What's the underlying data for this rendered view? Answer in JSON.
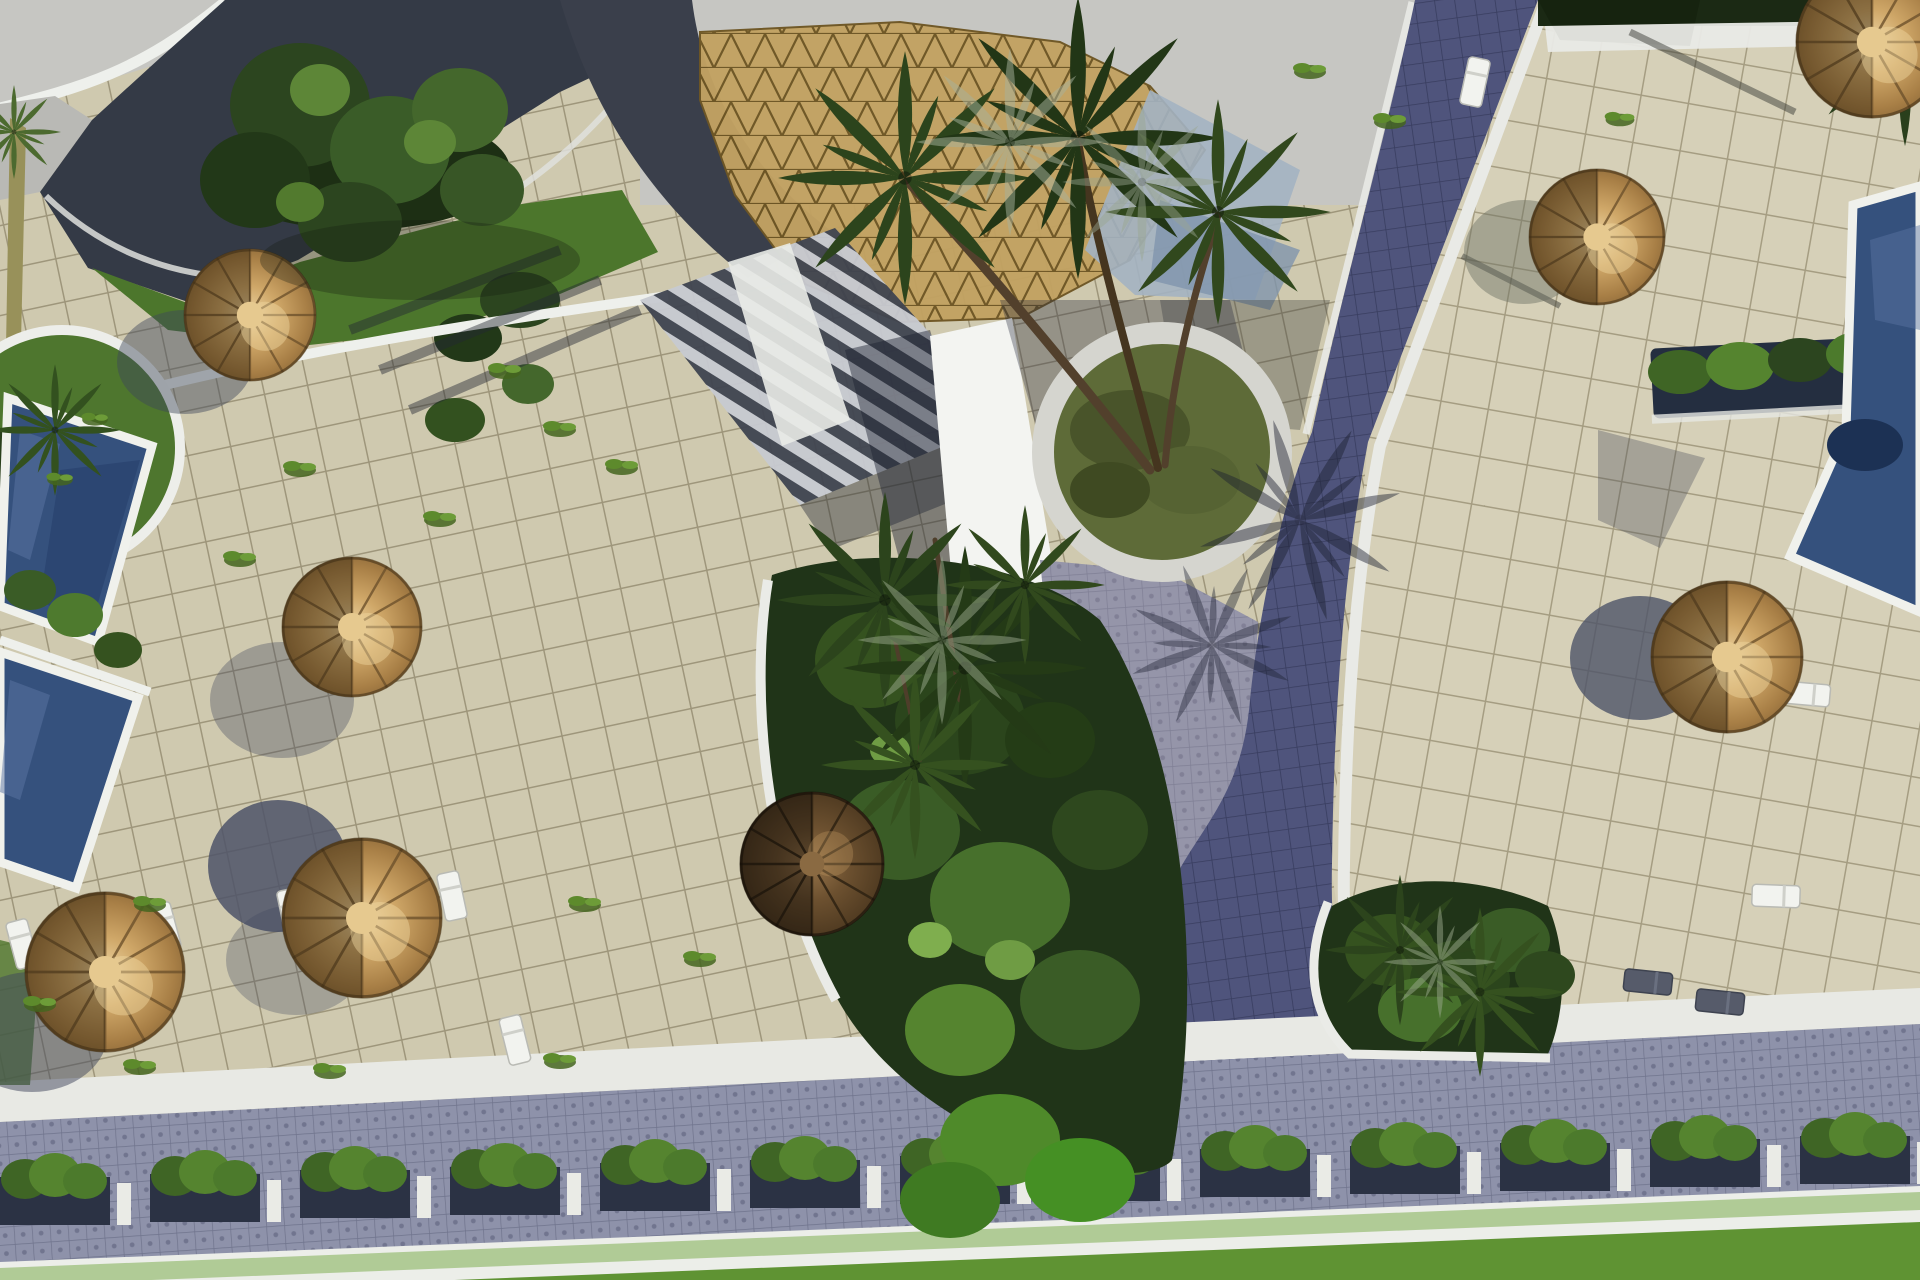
{
  "scene": {
    "description": "Aerial 3D architectural rendering of a resort pool courtyard: beige paved terraces, dark-blue swimming pools with white rims, indigo paver walkways, straw parasols with sun loungers, palm trees in round and organic planters, a golden lattice dome roof at top, a bottom road lined with shrub planter boxes and a green lawn strip.",
    "setting": "resort-courtyard-aerial-render",
    "visible_text": [],
    "counts": {
      "straw_umbrellas": 7,
      "dark_umbrellas": 1,
      "swimming_pools": 3,
      "lounge_chairs": 10,
      "planter_boxes": 13,
      "palm_clusters": 6
    },
    "umbrellas": [
      {
        "x": 250,
        "y": 315,
        "r": 66
      },
      {
        "x": 352,
        "y": 627,
        "r": 70
      },
      {
        "x": 105,
        "y": 972,
        "r": 80
      },
      {
        "x": 362,
        "y": 918,
        "r": 80
      },
      {
        "x": 1597,
        "y": 237,
        "r": 68
      },
      {
        "x": 1872,
        "y": 42,
        "r": 76
      },
      {
        "x": 1727,
        "y": 657,
        "r": 76
      },
      {
        "x": 812,
        "y": 864,
        "r": 72,
        "dark": true
      }
    ],
    "shadow_discs": [
      [
        185,
        362,
        68,
        52,
        "#3f465c",
        0.45
      ],
      [
        282,
        700,
        72,
        58,
        "#3f465c",
        0.35
      ],
      [
        278,
        866,
        70,
        66,
        "#4d5468",
        0.85
      ],
      [
        32,
        1032,
        76,
        60,
        "#3f465c",
        0.5
      ],
      [
        1524,
        252,
        60,
        52,
        "#6a6f62",
        0.45
      ],
      [
        1640,
        658,
        70,
        62,
        "#4d5468",
        0.8
      ],
      [
        296,
        960,
        70,
        55,
        "#3f465c",
        0.3
      ]
    ],
    "chairs": [
      {
        "x": 22,
        "y": 944,
        "rot": -15
      },
      {
        "x": 165,
        "y": 927,
        "rot": -15
      },
      {
        "x": 292,
        "y": 913,
        "rot": -12
      },
      {
        "x": 452,
        "y": 896,
        "rot": -12
      },
      {
        "x": 515,
        "y": 1040,
        "rot": -14
      },
      {
        "x": 1806,
        "y": 694,
        "rot": 95
      },
      {
        "x": 1776,
        "y": 896,
        "rot": 92
      },
      {
        "x": 1475,
        "y": 82,
        "rot": 12
      },
      {
        "x": 1648,
        "y": 982,
        "rot": 96,
        "dark": true
      },
      {
        "x": 1720,
        "y": 1002,
        "rot": 96,
        "dark": true
      }
    ],
    "palms": [
      [
        905,
        178,
        1.35,
        "#2c441c"
      ],
      [
        1078,
        138,
        1.5,
        "#223616"
      ],
      [
        1218,
        212,
        1.2,
        "#31481d"
      ],
      [
        1010,
        142,
        1.0,
        "#a7b29c",
        0.5
      ],
      [
        1142,
        182,
        0.85,
        "#9aa690",
        0.45
      ],
      [
        885,
        600,
        1.15,
        "#2c441c"
      ],
      [
        965,
        668,
        1.3,
        "#243a16"
      ],
      [
        915,
        765,
        1.0,
        "#35511f"
      ],
      [
        1025,
        585,
        0.85,
        "#31491d"
      ],
      [
        942,
        640,
        0.9,
        "#9aa98c",
        0.5
      ],
      [
        55,
        430,
        0.7,
        "#33511f"
      ],
      [
        1400,
        950,
        0.8,
        "#2c441c"
      ],
      [
        1480,
        992,
        0.9,
        "#35511f"
      ],
      [
        1440,
        962,
        0.6,
        "#9aa98c",
        0.5
      ],
      [
        1905,
        38,
        1.15,
        "#2a3f1c"
      ],
      [
        14,
        132,
        0.5,
        "#4c6a2f"
      ],
      [
        1300,
        520,
        1.1,
        "#1c2030",
        0.45,
        30
      ],
      [
        1212,
        645,
        0.9,
        "#1c2030",
        0.4,
        -20
      ]
    ],
    "planter_boxes": [
      [
        55,
        1177
      ],
      [
        205,
        1174
      ],
      [
        355,
        1170
      ],
      [
        505,
        1167
      ],
      [
        655,
        1163
      ],
      [
        805,
        1160
      ],
      [
        955,
        1156
      ],
      [
        1105,
        1153
      ],
      [
        1255,
        1149
      ],
      [
        1405,
        1146
      ],
      [
        1555,
        1143
      ],
      [
        1705,
        1139
      ],
      [
        1855,
        1136
      ]
    ],
    "tufts": [
      [
        505,
        372,
        1
      ],
      [
        560,
        430,
        1
      ],
      [
        300,
        470,
        1
      ],
      [
        622,
        468,
        1
      ],
      [
        240,
        560,
        1
      ],
      [
        150,
        905,
        1
      ],
      [
        40,
        1005,
        1
      ],
      [
        585,
        905,
        1
      ],
      [
        700,
        960,
        1
      ],
      [
        560,
        1062,
        1
      ],
      [
        140,
        1068,
        1
      ],
      [
        330,
        1072,
        1
      ],
      [
        1390,
        122,
        1
      ],
      [
        1310,
        72,
        1
      ],
      [
        60,
        480,
        0.8
      ],
      [
        95,
        420,
        0.8
      ],
      [
        1620,
        120,
        0.9
      ],
      [
        440,
        520,
        1
      ]
    ],
    "foliage": {
      "left": [
        [
          360,
          170,
          150,
          60,
          "#1d2f14"
        ],
        [
          300,
          105,
          70,
          62,
          "#2c451f"
        ],
        [
          390,
          150,
          60,
          54,
          "#3a5c28"
        ],
        [
          255,
          180,
          55,
          48,
          "#223818"
        ],
        [
          460,
          110,
          48,
          42,
          "#44672c"
        ],
        [
          350,
          222,
          52,
          40,
          "#2c451f"
        ],
        [
          482,
          190,
          42,
          36,
          "#385626"
        ],
        [
          320,
          90,
          30,
          26,
          "#5d8637"
        ],
        [
          430,
          142,
          26,
          22,
          "#5d8637"
        ],
        [
          300,
          202,
          24,
          20,
          "#527a2e"
        ],
        [
          520,
          300,
          40,
          28,
          "#2c451f"
        ],
        [
          468,
          338,
          34,
          24,
          "#223818"
        ],
        [
          455,
          420,
          30,
          22,
          "#33511f"
        ],
        [
          528,
          384,
          26,
          20,
          "#44672c"
        ]
      ],
      "center": [
        [
          870,
          660,
          55,
          48,
          "#35521f"
        ],
        [
          960,
          720,
          65,
          55,
          "#2b451c"
        ],
        [
          900,
          830,
          60,
          50,
          "#3a5c26"
        ],
        [
          1000,
          900,
          70,
          58,
          "#47702c"
        ],
        [
          1080,
          1000,
          60,
          50,
          "#3a5c26"
        ],
        [
          960,
          1030,
          55,
          46,
          "#55842f"
        ],
        [
          1100,
          830,
          48,
          40,
          "#2e481e"
        ],
        [
          1050,
          740,
          45,
          38,
          "#243c16"
        ],
        [
          1010,
          960,
          25,
          20,
          "#6f9c44"
        ],
        [
          930,
          940,
          22,
          18,
          "#7fae4e"
        ],
        [
          890,
          750,
          20,
          16,
          "#6f9c44"
        ],
        [
          1000,
          1140,
          60,
          46,
          "#4f8a2a"
        ],
        [
          1080,
          1180,
          55,
          42,
          "#459024"
        ],
        [
          950,
          1200,
          50,
          38,
          "#3f7a22"
        ]
      ],
      "right": [
        [
          1390,
          950,
          45,
          36,
          "#35521f"
        ],
        [
          1460,
          980,
          50,
          40,
          "#2b451c"
        ],
        [
          1510,
          940,
          40,
          32,
          "#3a5c26"
        ],
        [
          1420,
          1010,
          42,
          32,
          "#47702c"
        ],
        [
          1545,
          975,
          30,
          24,
          "#2e481e"
        ]
      ],
      "hedge": [
        [
          1680,
          372,
          32,
          22,
          "#3f6525"
        ],
        [
          1740,
          366,
          34,
          24,
          "#55842f"
        ],
        [
          1800,
          360,
          32,
          22,
          "#2c451f"
        ],
        [
          1858,
          354,
          32,
          22,
          "#4c7a2c"
        ],
        [
          1905,
          349,
          26,
          18,
          "#3f6525"
        ]
      ],
      "poolside": [
        [
          30,
          590,
          26,
          20,
          "#3a5c26"
        ],
        [
          75,
          615,
          28,
          22,
          "#4e7a2e"
        ],
        [
          118,
          650,
          24,
          18,
          "#35521f"
        ]
      ],
      "plantercircle": [
        [
          1130,
          430,
          60,
          40,
          "#49542a"
        ],
        [
          1190,
          480,
          50,
          34,
          "#566333"
        ],
        [
          1110,
          490,
          40,
          28,
          "#3f4a22"
        ]
      ]
    }
  },
  "palette": {
    "sky": "#c6c6c2",
    "tile_left": "#cfc9af",
    "tile_right": "#d6d0b8",
    "grout": "#9e967b",
    "road": "#4f547c",
    "road_light": "#8e92aa",
    "apron": "#a79ca8",
    "pool": "#35517d",
    "pool_deep": "#27406a",
    "pool_light": "#5b76a4",
    "white_trim": "#eef0ec",
    "lawn": "#5f9333",
    "lawn_light": "#74a844",
    "grass": "#4c762c",
    "foliage_dark": "#203418",
    "foliage_mid": "#3a5c26",
    "foliage_light": "#6f9c44",
    "umbrella_straw": "#c49a5d",
    "umbrella_dark": "#4e3a22",
    "roof_dark": "#343a46",
    "dome_gold": "#c2a262",
    "dome_lattice": "#6e5624",
    "planter_box": "#2b3244",
    "stone_rim": "#d5d5cf",
    "shadow": "#3f465c"
  }
}
